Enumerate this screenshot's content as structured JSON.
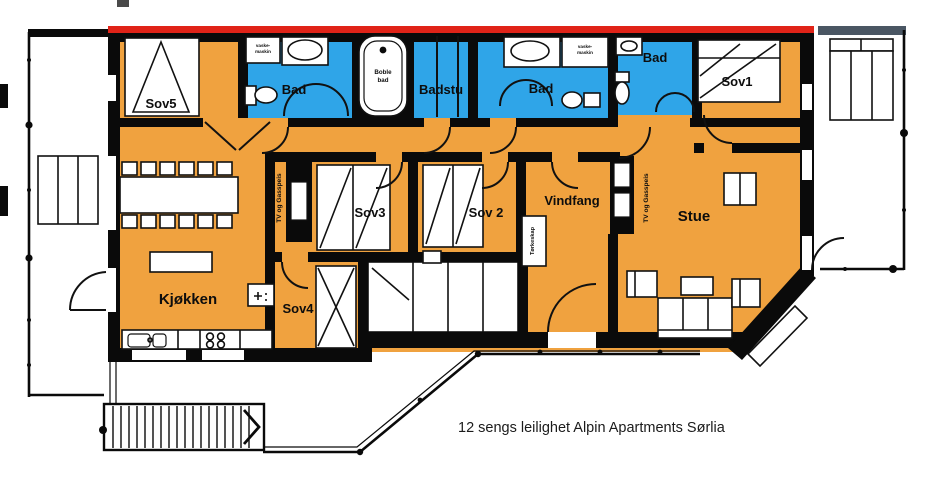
{
  "caption": "12 sengs leilighet Alpin Apartments Sørlia",
  "colors": {
    "room_orange": "#F0A23F",
    "wet_blue": "#2FA5E8",
    "roof_red": "#E02318",
    "balcony_slate": "#4A5663",
    "wall_black": "#0A0A0A"
  },
  "rooms": {
    "sov5": "Sov5",
    "sov4": "Sov4",
    "sov3": "Sov3",
    "sov2": "Sov 2",
    "sov1": "Sov1",
    "kjokken": "Kjøkken",
    "stue": "Stue",
    "vindfang": "Vindfang",
    "badstu": "Badstu",
    "bad": "Bad"
  },
  "annotations": {
    "boble_line1": "Boble",
    "boble_line2": "bad",
    "vaskemaskin_line1": "vaske-",
    "vaskemaskin_line2": "maskin",
    "torkeskap": "Tørkeskap",
    "tv_gasspeis": "TV og Gasspeis"
  }
}
